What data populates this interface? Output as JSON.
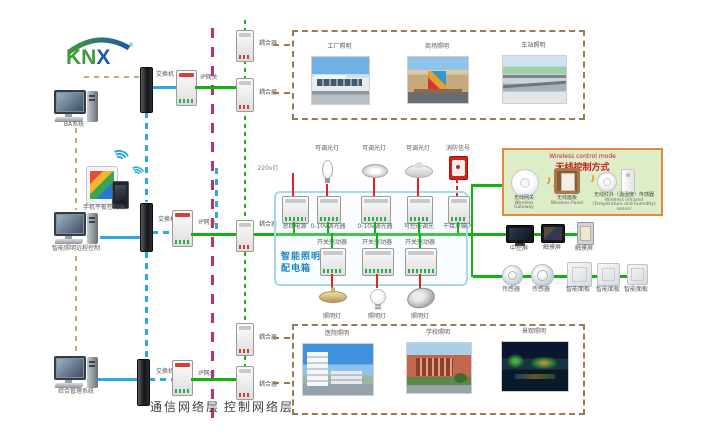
{
  "logo": {
    "green_part": "KN",
    "blue_part": "X",
    "reg": "®"
  },
  "terminals": {
    "ba": "BA系统",
    "mobile": "手机平板控制端",
    "remote": "智能照明远程控制",
    "management": "综合管理系统"
  },
  "network": {
    "switch": "交换机",
    "gateway": "IP网关",
    "coupler": "耦合器"
  },
  "layers": {
    "communication": "通信网络层",
    "control": "控制网络层"
  },
  "top_scenes": [
    {
      "label": "工厂照明"
    },
    {
      "label": "商场照明"
    },
    {
      "label": "车站照明"
    }
  ],
  "bottom_scenes": [
    {
      "label": "医院照明"
    },
    {
      "label": "学校照明"
    },
    {
      "label": "景观照明"
    }
  ],
  "panel_box": {
    "title_line1": "智能照明",
    "title_line2": "配电箱",
    "power_label": "220v灯",
    "dimmable_lamp": "可调光灯",
    "fire_signal": "消防信号",
    "lamp_label": "照明灯",
    "modules_row1": [
      "总线电源",
      "0-10v调光器",
      "0-10v调光器",
      "可控硅调光",
      "干接点输入"
    ],
    "modules_row2": [
      "开关驱动器",
      "开关驱动器",
      "开关驱动器"
    ]
  },
  "wireless": {
    "title_en": "Wireless control mode",
    "title_zh": "无线控制方式",
    "devices": [
      {
        "zh": "无线网关",
        "en": "Wireless Gateway"
      },
      {
        "zh": "无线面板",
        "en": "Wireless Panel"
      },
      {
        "zh": "无线红外（温湿度）传感器",
        "en": "Wireless infrared (Temperature and humidity) sensor"
      }
    ]
  },
  "right_row1": [
    "中控屏",
    "触摸屏",
    "触摸屏"
  ],
  "right_row2": [
    "传感器",
    "传感器",
    "智能面板",
    "智能面板",
    "智能面板"
  ],
  "colors": {
    "green": "#12b212",
    "blue": "#29aae3",
    "magenta": "#bb2f7d",
    "tan": "#c6a96f",
    "brown": "#9b7a56",
    "red": "#e42320",
    "orange": "#e2a13a",
    "box_blue": "#a5d9ef",
    "wireless_bg": "#dcedc8",
    "wireless_border": "#e08a3c",
    "title_red": "#cc1f1f",
    "text_blue": "#1887c9"
  }
}
